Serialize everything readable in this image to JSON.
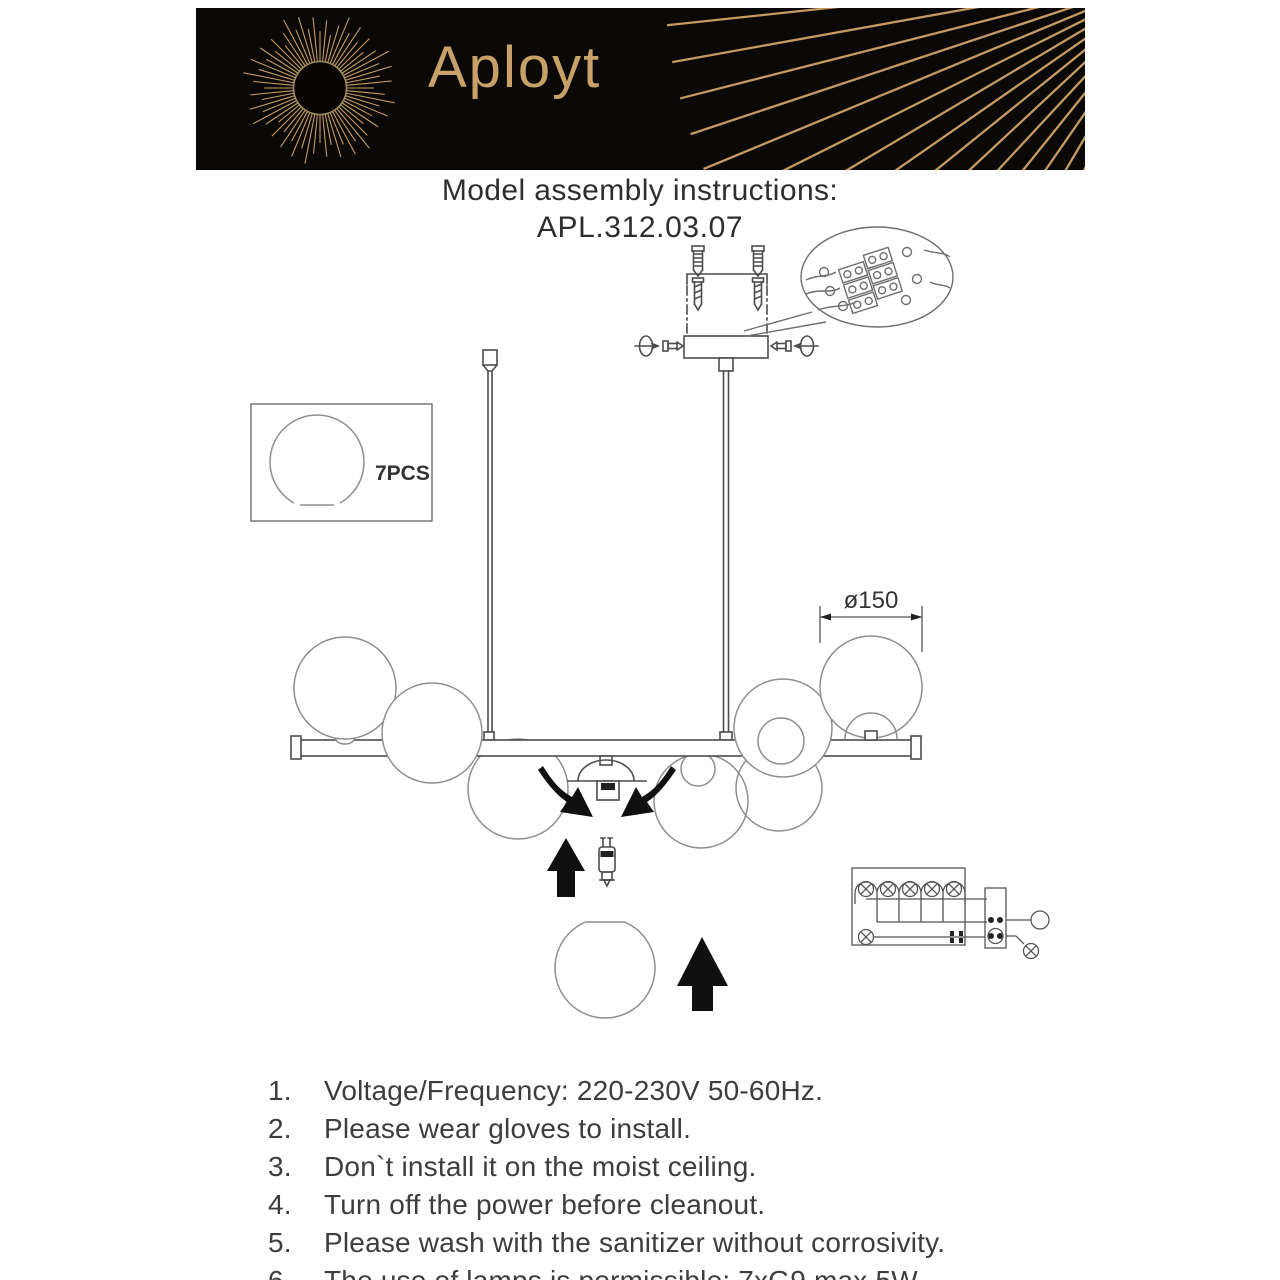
{
  "brand": {
    "name": "Aployt",
    "logo": "sunburst-icon"
  },
  "title": {
    "line1": "Model assembly instructions:",
    "line2": "APL.312.03.07"
  },
  "diagram": {
    "parts_box": {
      "label": "7PCS"
    },
    "dimension": {
      "label": "ø150"
    }
  },
  "instructions": [
    {
      "num": "1.",
      "text": "Voltage/Frequency: 220-230V 50-60Hz."
    },
    {
      "num": "2.",
      "text": "Please wear gloves to install."
    },
    {
      "num": "3.",
      "text": "Don`t install it on the moist ceiling."
    },
    {
      "num": "4.",
      "text": "Turn off the power before cleanout."
    },
    {
      "num": "5.",
      "text": "Please wash with the sanitizer without corrosivity."
    },
    {
      "num": "6.",
      "text": "The use of lamps is permissible: 7xG9 max 5W."
    }
  ],
  "colors": {
    "gold": "#c49a62",
    "gold_bright": "#e4c astri",
    "ink": "#3a3a3a",
    "line": "#4c4c4c",
    "banner_bg": "#0b0908"
  }
}
